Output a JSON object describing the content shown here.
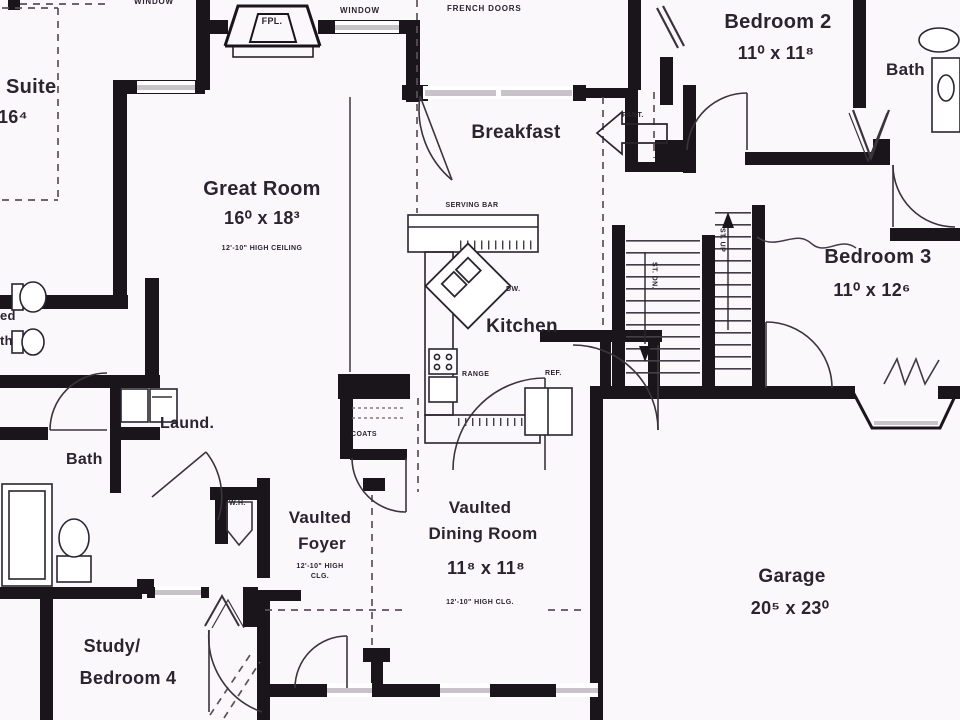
{
  "plan": {
    "colors": {
      "background": "#faf8fa",
      "wall_ink": "#1a151b",
      "thin_line": "#3f3942",
      "window_gray": "#c7c3c8",
      "text": "#2a2330"
    },
    "rooms": {
      "suite": {
        "name": "Suite",
        "dims": "16⁴"
      },
      "great_room": {
        "name": "Great Room",
        "dims": "16⁰ x 18³",
        "ceiling_note": "12'-10\" HIGH CEILING"
      },
      "breakfast": {
        "name": "Breakfast"
      },
      "bedroom2": {
        "name": "Bedroom 2",
        "dims": "11⁰ x 11⁸"
      },
      "bath_upper": {
        "name": "Bath"
      },
      "kitchen": {
        "name": "Kitchen"
      },
      "bedroom3": {
        "name": "Bedroom 3",
        "dims": "11⁰ x 12⁶"
      },
      "laundry": {
        "name": "Laund."
      },
      "bath_lower": {
        "name": "Bath"
      },
      "bath_left_partial": {
        "line1": "ed",
        "line2": "th"
      },
      "foyer": {
        "name1": "Vaulted",
        "name2": "Foyer",
        "ceiling_note1": "12'-10\" HIGH",
        "ceiling_note2": "CLG."
      },
      "dining": {
        "name1": "Vaulted",
        "name2": "Dining Room",
        "dims": "11⁸ x 11⁸",
        "ceiling_note": "12'-10\" HIGH CLG."
      },
      "garage": {
        "name": "Garage",
        "dims": "20⁵ x 23⁰"
      },
      "study": {
        "name1": "Study/",
        "name2": "Bedroom 4"
      }
    },
    "annotations": {
      "window_left": "WINDOW",
      "window_right": "WINDOW",
      "fireplace": "FPL.",
      "french_doors": "FRENCH DOORS",
      "serving_bar": "SERVING BAR",
      "dishwasher": "DW.",
      "range": "RANGE",
      "refrigerator": "REF.",
      "pantry": "PANT.",
      "stairs_down": "ST. DN.",
      "stairs_up": "ST. UP",
      "water_heater": "W.H.",
      "coats": "COATS"
    }
  }
}
